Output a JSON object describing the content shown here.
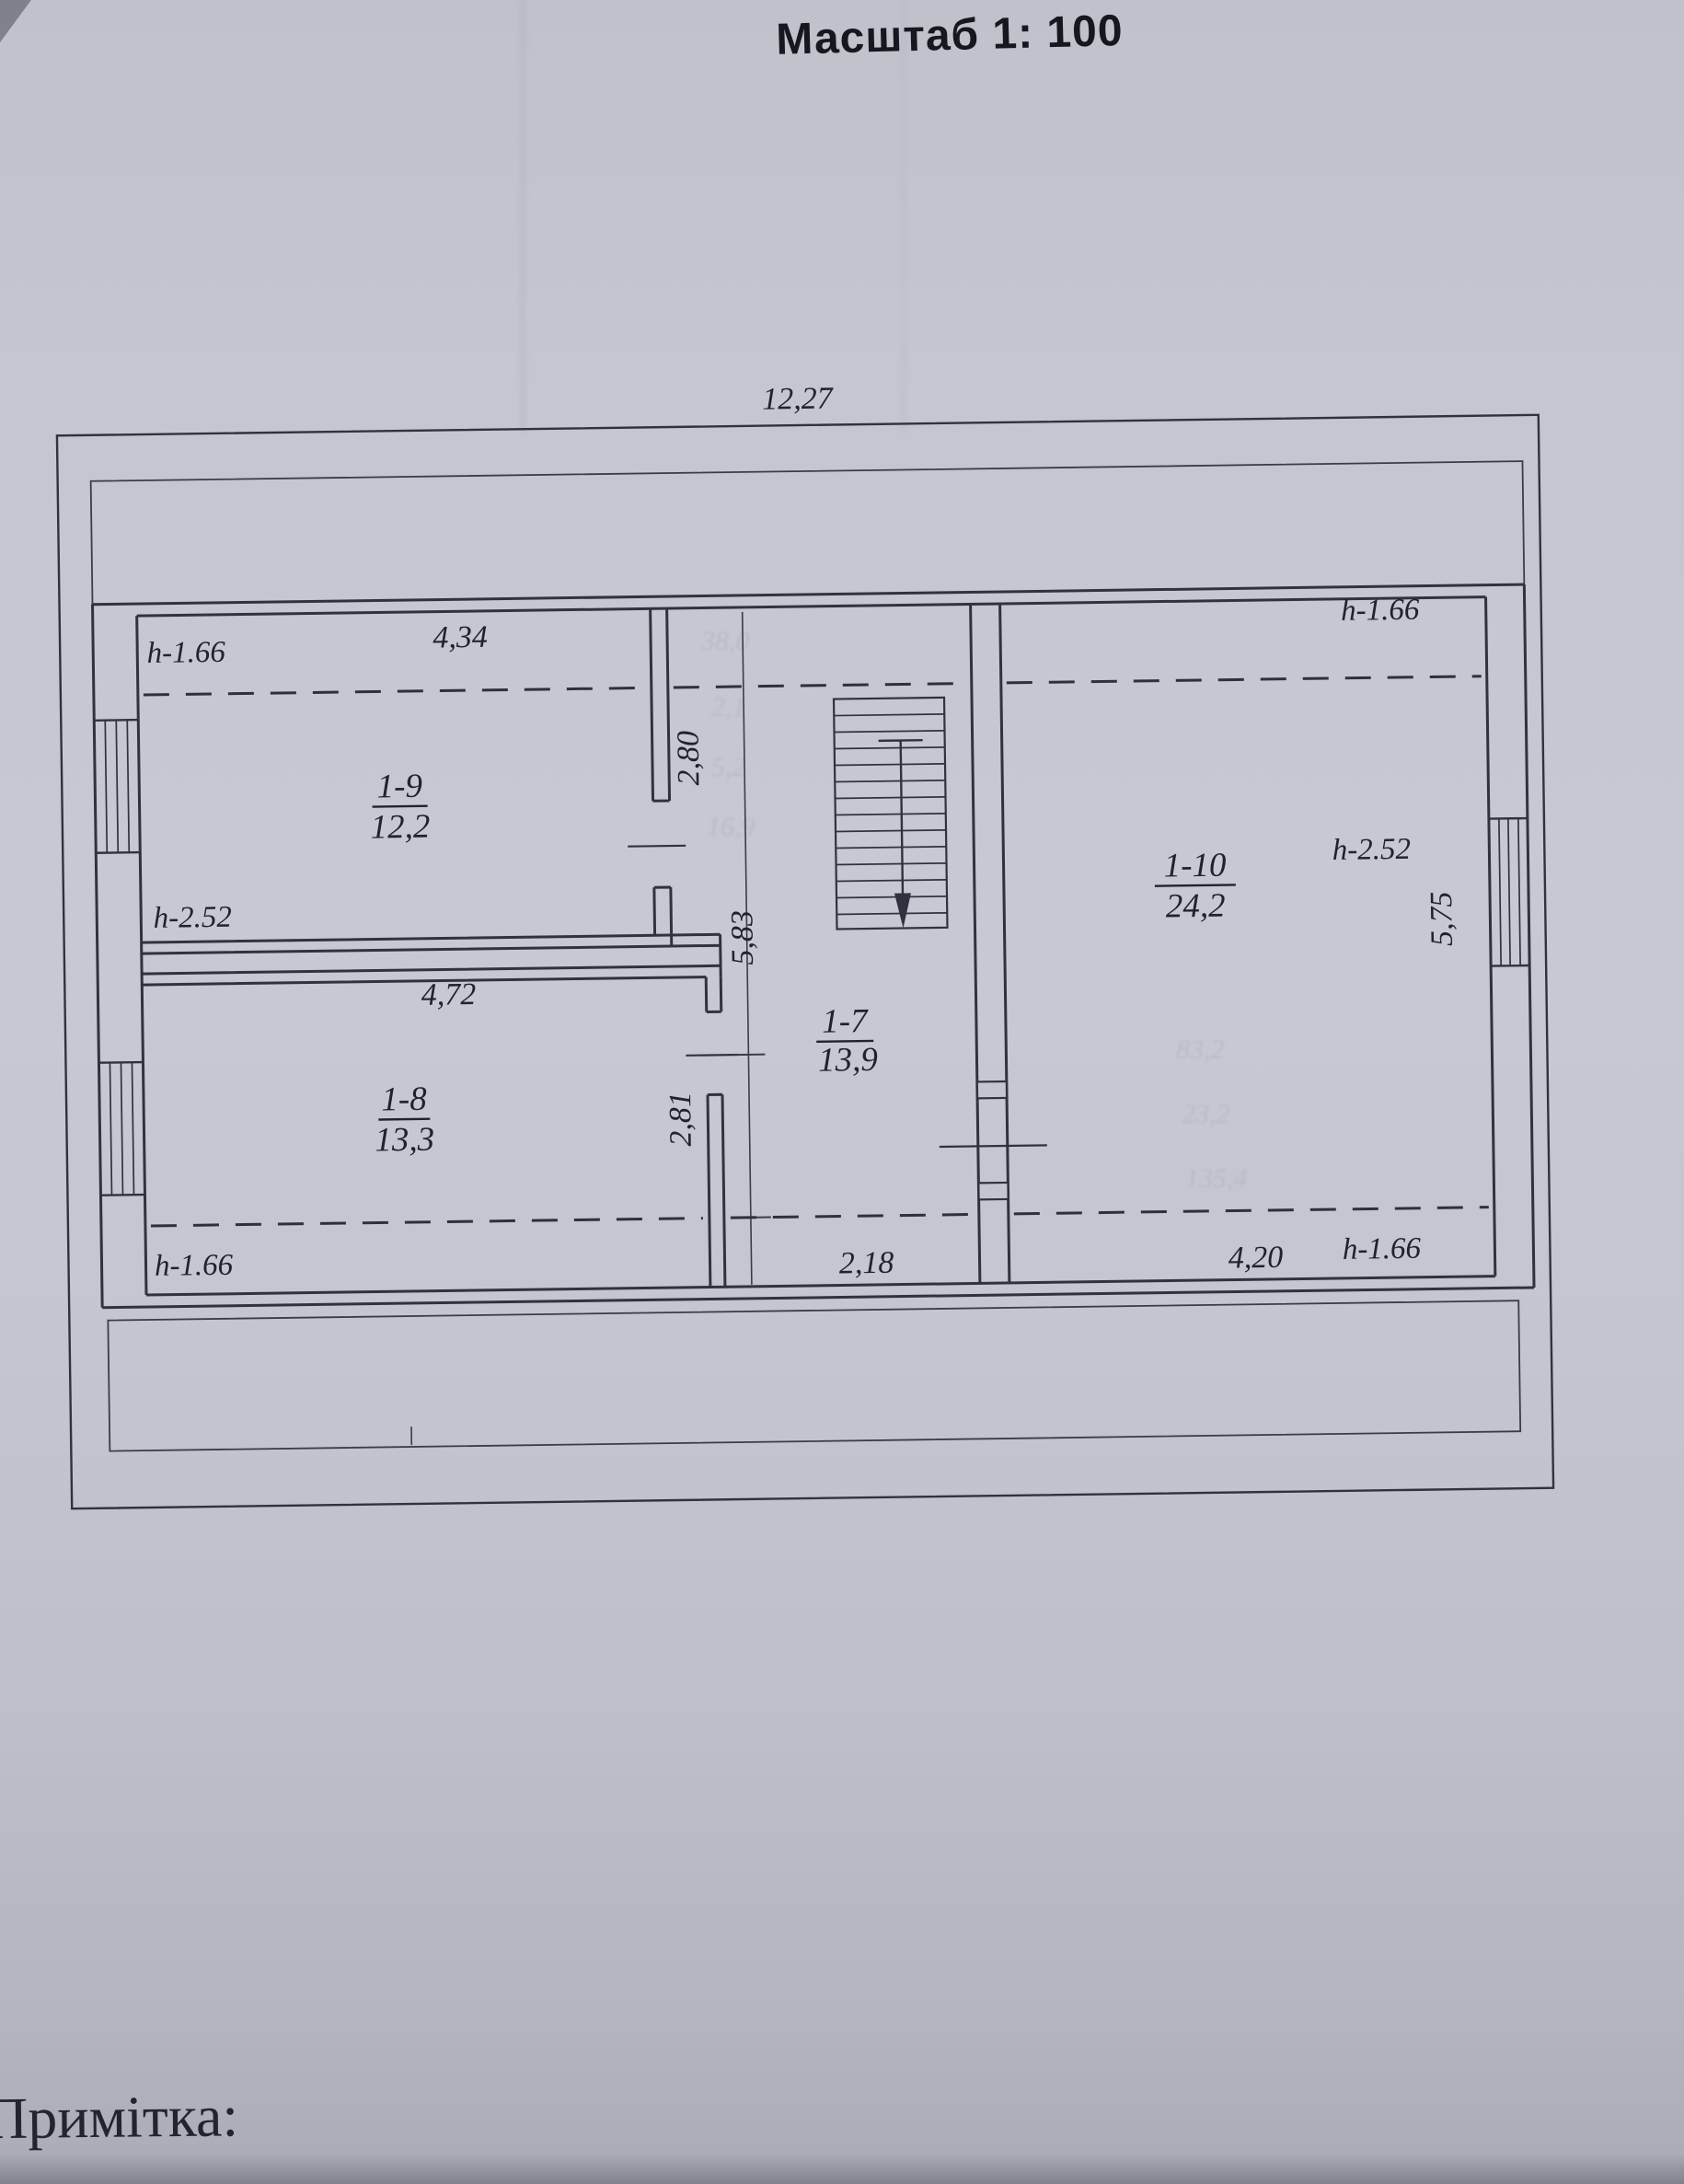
{
  "colors": {
    "paper": "#c3c5cf",
    "ink": "#30323f",
    "text": "#20222e"
  },
  "plan": {
    "scale_title": "Масштаб 1: 100",
    "overall_width": "12,27",
    "rooms": [
      {
        "id": "1-9",
        "area": "12,2",
        "width": "4,34",
        "depth": "2,80",
        "h_top": "h-1.66",
        "h_bottom": "h-2.52"
      },
      {
        "id": "1-8",
        "area": "13,3",
        "width": "4,72",
        "depth": "2,81",
        "h_bottom": "h-1.66"
      },
      {
        "id": "1-7",
        "area": "13,9",
        "width": "2,18",
        "depth": "5,83"
      },
      {
        "id": "1-10",
        "area": "24,2",
        "width": "4,20",
        "depth": "5,75",
        "h_top": "h-1.66",
        "h_mid": "h-2.52",
        "h_bottom": "h-1.66"
      }
    ]
  },
  "note": {
    "label": "Примітка:"
  },
  "ghost_marks": [
    "38,0",
    "2,1",
    "5,2",
    "16,9",
    "83,2",
    "23,2",
    "135,4"
  ]
}
